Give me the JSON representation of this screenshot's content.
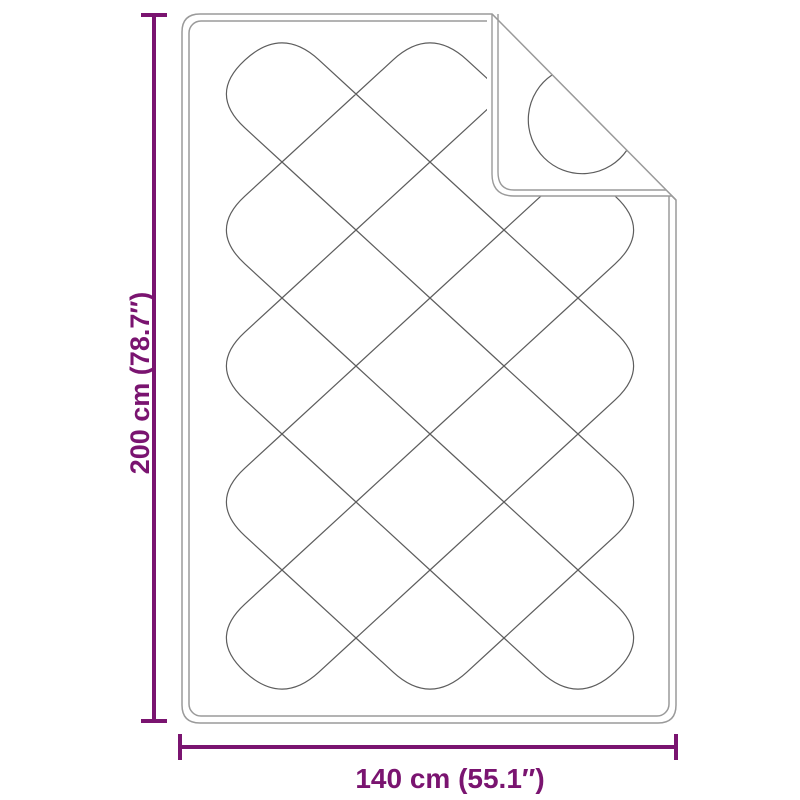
{
  "diagram": {
    "height_label": "200 cm (78.7″)",
    "width_label": "140 cm (55.1″)"
  },
  "colors": {
    "dimension": "#7a1470",
    "outline": "#9a9a9a",
    "stitch": "#5d5d5d",
    "background": "#ffffff"
  }
}
